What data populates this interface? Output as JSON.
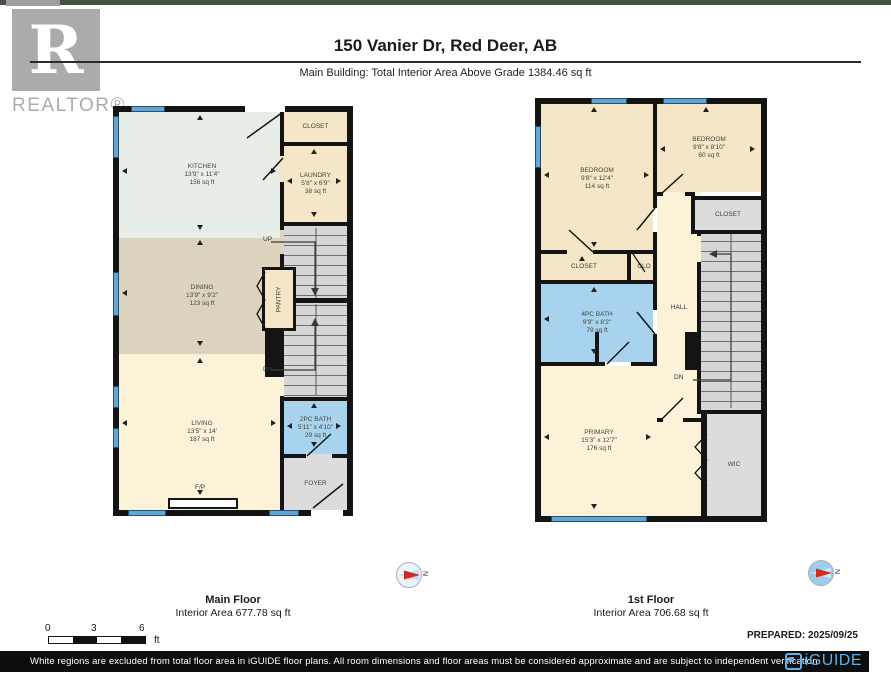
{
  "header": {
    "title": "150 Vanier Dr, Red Deer, AB",
    "subtitle": "Main Building: Total Interior Area Above Grade 1384.46 sq ft",
    "realtor_word": "REALTOR®",
    "realtor_r": "R"
  },
  "plans": {
    "main_floor": {
      "label": "Main Floor",
      "area_label": "Interior Area 677.78 sq ft",
      "rooms": {
        "kitchen": {
          "name": "KITCHEN",
          "dims": "13'9\" x 11'4\"",
          "area": "156 sq ft"
        },
        "closet": {
          "name": "CLOSET"
        },
        "laundry": {
          "name": "LAUNDRY",
          "dims": "5'8\" x 6'9\"",
          "area": "38 sq ft"
        },
        "dining": {
          "name": "DINING",
          "dims": "13'9\" x 9'2\"",
          "area": "123 sq ft"
        },
        "pantry": {
          "name": "PANTRY"
        },
        "living": {
          "name": "LIVING",
          "dims": "13'5\" x 14'",
          "area": "187 sq ft"
        },
        "bath2pc": {
          "name": "2PC BATH",
          "dims": "5'11\" x 4'10\"",
          "area": "29 sq ft"
        },
        "foyer": {
          "name": "FOYER"
        },
        "fireplace": "F/P",
        "up": "UP",
        "dn": "DN"
      }
    },
    "first_floor": {
      "label": "1st Floor",
      "area_label": "Interior Area 706.68 sq ft",
      "rooms": {
        "bedroom1": {
          "name": "BEDROOM",
          "dims": "9'8\" x 12'4\"",
          "area": "114 sq ft"
        },
        "bedroom2": {
          "name": "BEDROOM",
          "dims": "9'8\" x 8'10\"",
          "area": "80 sq ft"
        },
        "closet_top": {
          "name": "CLOSET"
        },
        "closet_left": {
          "name": "CLOSET"
        },
        "clo": {
          "name": "CLO"
        },
        "bath4pc": {
          "name": "4PC BATH",
          "dims": "9'9\" x 8'2\"",
          "area": "79 sq ft"
        },
        "hall": {
          "name": "HALL"
        },
        "primary": {
          "name": "PRIMARY",
          "dims": "15'3\" x 12'7\"",
          "area": "176 sq ft"
        },
        "wic": {
          "name": "WIC"
        },
        "dn": "DN"
      }
    }
  },
  "compass": {
    "north_label": "N"
  },
  "scale_bar": {
    "labels": [
      "0",
      "3",
      "6"
    ],
    "unit": "ft"
  },
  "prepared": "PREPARED: 2025/09/25",
  "footer": {
    "disclaimer": "White regions are excluded from total floor area in iGUIDE floor plans. All room dimensions and floor areas must be considered approximate and are subject to independent verification.",
    "brand": "iGUIDE"
  },
  "colors": {
    "wall": "#141414",
    "window_blue": "#66a5cf",
    "bath_blue": "#a8d3ef",
    "room_tan": "#f4e6c6",
    "dining_tan": "#dbd3bd",
    "living_cream": "#fbf2d7",
    "kitchen_mint": "#e7eee8",
    "utility_gray": "#dcdcdc",
    "brand_blue": "#5fb0e5",
    "compass_red": "#cf2b20"
  }
}
